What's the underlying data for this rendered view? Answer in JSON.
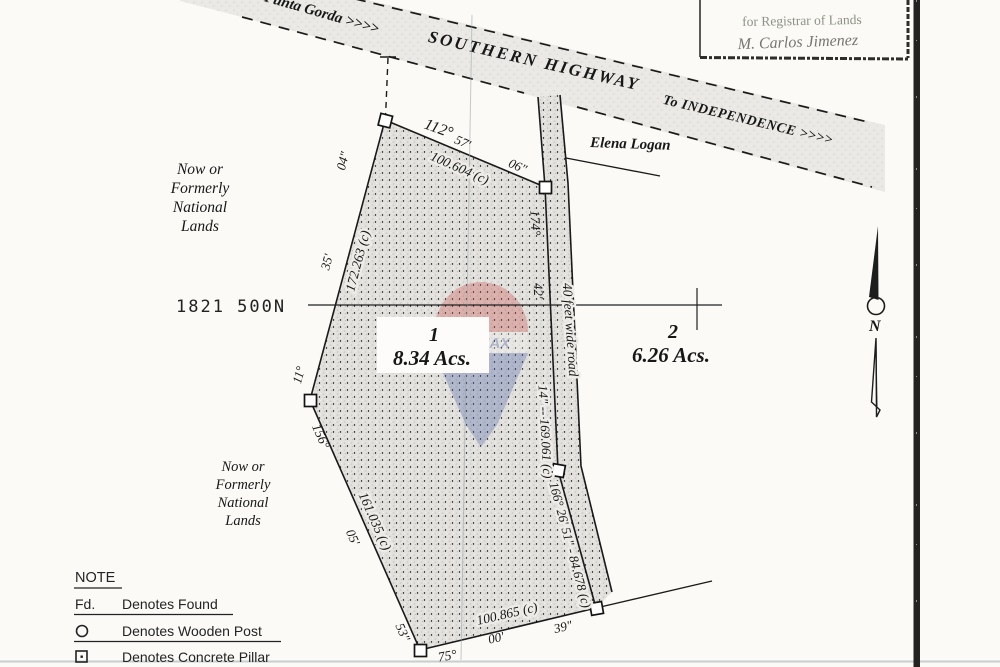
{
  "page": {
    "background": "#fbfaf7",
    "ink": "#1a1a1a"
  },
  "highway": {
    "from_label": "From Punta Gorda >>>>",
    "name": "SOUTHERN HIGHWAY",
    "to_label": "To INDEPENDENCE >>>>"
  },
  "stamp": {
    "line1": "for Registrar of Lands",
    "line2": "M. Carlos Jimenez"
  },
  "owners": {
    "north_parcel_owner": "Elena Logan",
    "national_lands": [
      "Now or",
      "Formerly",
      "National",
      "Lands"
    ]
  },
  "grid": {
    "northing": "1821 500N"
  },
  "parcels": {
    "p1": {
      "number": "1",
      "area": "8.34 Acs."
    },
    "p2": {
      "number": "2",
      "area": "6.26 Acs."
    }
  },
  "road": {
    "label": "40 feet wide road"
  },
  "bearings": {
    "top_deg": "112°",
    "top_min": "57'",
    "top_sec": "06\"",
    "top_dist": "100.604 (c)",
    "wu_deg": "11°",
    "wu_min": "35'",
    "wu_sec": "04\"",
    "wu_dist": "172.263 (c)",
    "wl_deg": "156°",
    "wl_min": "05'",
    "wl_sec": "53\"",
    "wl_dist": "161.035 (c)",
    "rd_deg": "174°",
    "rd_min": "42'",
    "rd_secdist": "14\" -- 169.061 (c)",
    "rl_full": "166° 26' 51\" - 84.678 (c)",
    "bot_deg": "75°",
    "bot_min": "00'",
    "bot_sec": "39\"",
    "bot_dist": "100.865 (c)"
  },
  "compass": {
    "label": "N"
  },
  "legend": {
    "title": "NOTE",
    "items": [
      {
        "symbol": "Fd.",
        "text": "Denotes Found"
      },
      {
        "symbol": "wooden-post-circle",
        "text": "Denotes Wooden Post"
      },
      {
        "symbol": "concrete-pillar-square",
        "text": "Denotes Concrete Pillar"
      }
    ]
  },
  "watermark": {
    "brand": "RE/MAX",
    "red": "#c9423c",
    "blue": "#3c57a0"
  }
}
